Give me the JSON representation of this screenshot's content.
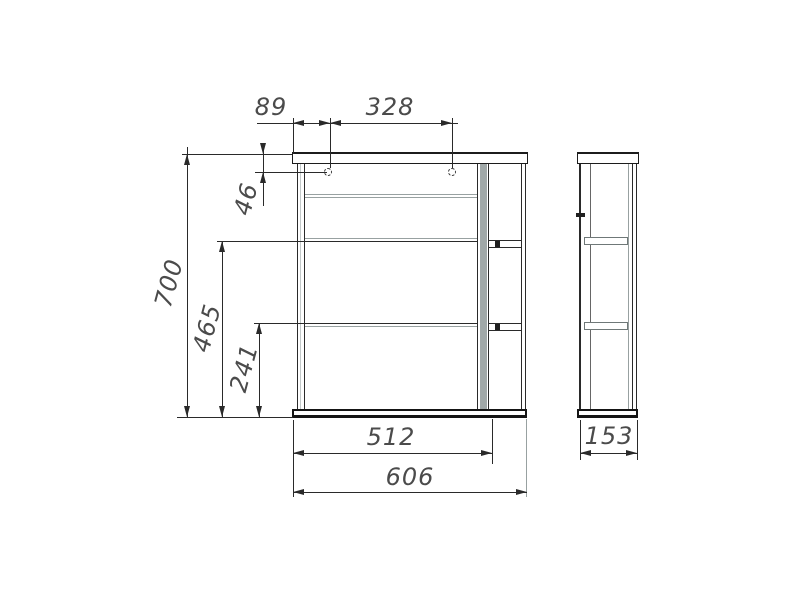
{
  "drawing": {
    "colors": {
      "background": "#ffffff",
      "line": "#2a2a2a",
      "thin_shelf_line": "#98a1a1",
      "text": "#4b4b4b"
    }
  },
  "dims": {
    "d89": "89",
    "d328": "328",
    "d46": "46",
    "d700": "700",
    "d465": "465",
    "d241": "241",
    "d512": "512",
    "d606": "606",
    "d153": "153"
  }
}
